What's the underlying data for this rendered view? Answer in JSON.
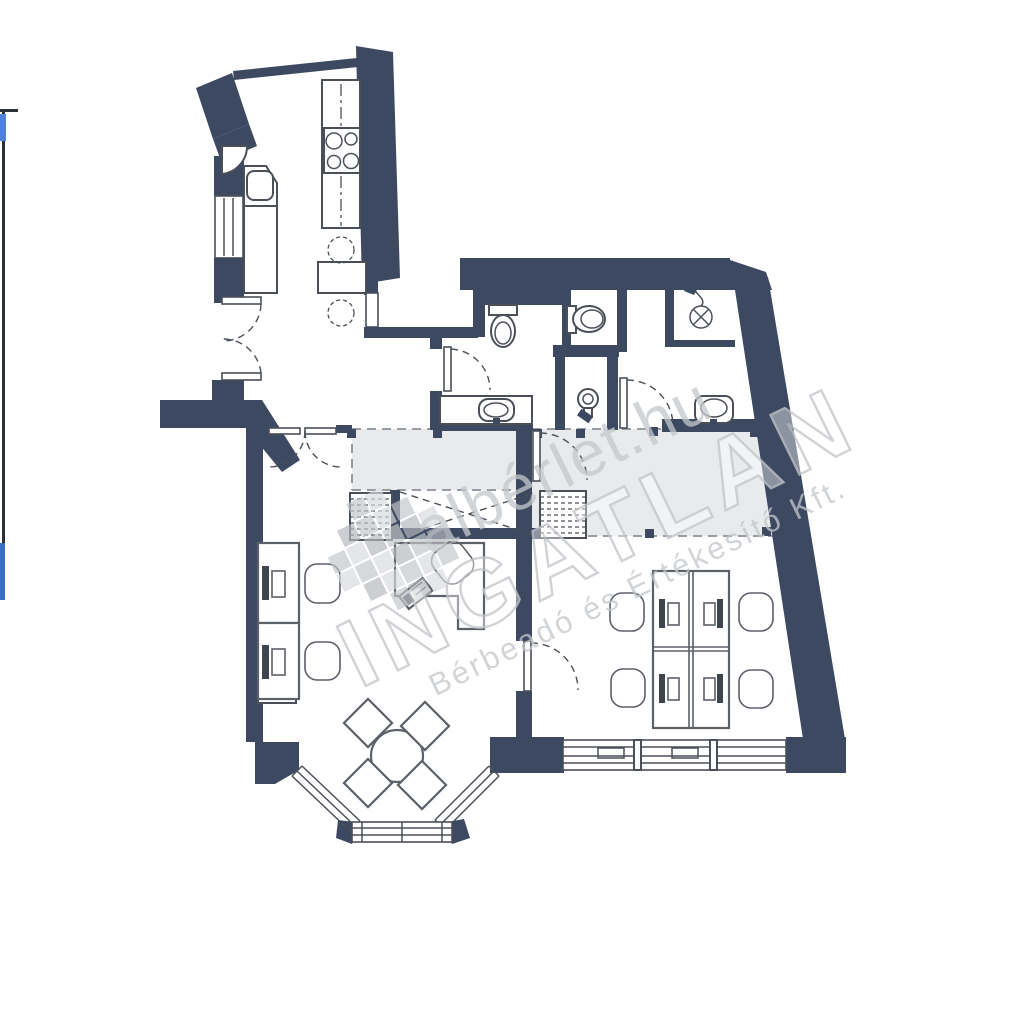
{
  "watermark": {
    "brand_small": "albérlet.hu",
    "brand_large": "INGATLAN",
    "subtitle": "Bérbeadó és Értékesítő Kft."
  },
  "palette": {
    "wall": "#3d4961",
    "line": "#4b5058",
    "furniture": "#5c6168",
    "gallery": "#e9eaec",
    "wmgray": "#c5c8cc",
    "edge_dark": "#2a2f3a",
    "edge_blue_top": "#4d82d8",
    "edge_blue_bottom": "#3a6fc4",
    "background": "#ffffff"
  }
}
